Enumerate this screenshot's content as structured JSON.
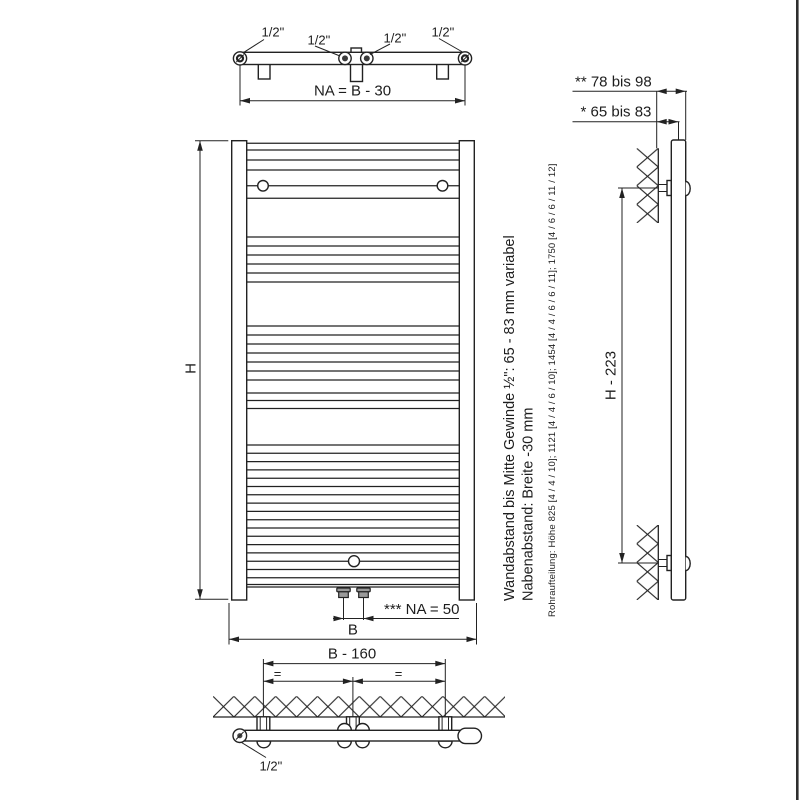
{
  "views": {
    "top": {
      "thread_labels": [
        "1/2\"",
        "1/2\"",
        "1/2\"",
        "1/2\""
      ],
      "hub_spacing": "NA = B - 30"
    },
    "front": {
      "height": "H",
      "width": "B",
      "valve_spacing": "*** NA = 50"
    },
    "side": {
      "wall_to_front": "** 78 bis 98",
      "wall_to_axis": "* 65 bis 83",
      "bracket_span": "H - 223"
    },
    "bottom": {
      "bracket_span": "B - 160",
      "equal_spacing": [
        "=",
        "="
      ],
      "thread_label": "1/2\""
    },
    "notes": {
      "wall_distance": "Wandabstand bis Mitte Gewinde ½\": 65 - 83 mm variabel",
      "hub_distance": "Nabenabstand: Breite -30 mm",
      "pipe_layout": "Rohraufteilung: Höhe 825 [4 / 4 / 10]; 1121 [4 / 4 / 6 / 10]; 1454 [4 / 4 / 6 / 6 / 11]; 1750 [4 / 6 / 6 / 11 / 12]"
    },
    "colors": {
      "line": "#222222",
      "background": "#ffffff"
    }
  }
}
